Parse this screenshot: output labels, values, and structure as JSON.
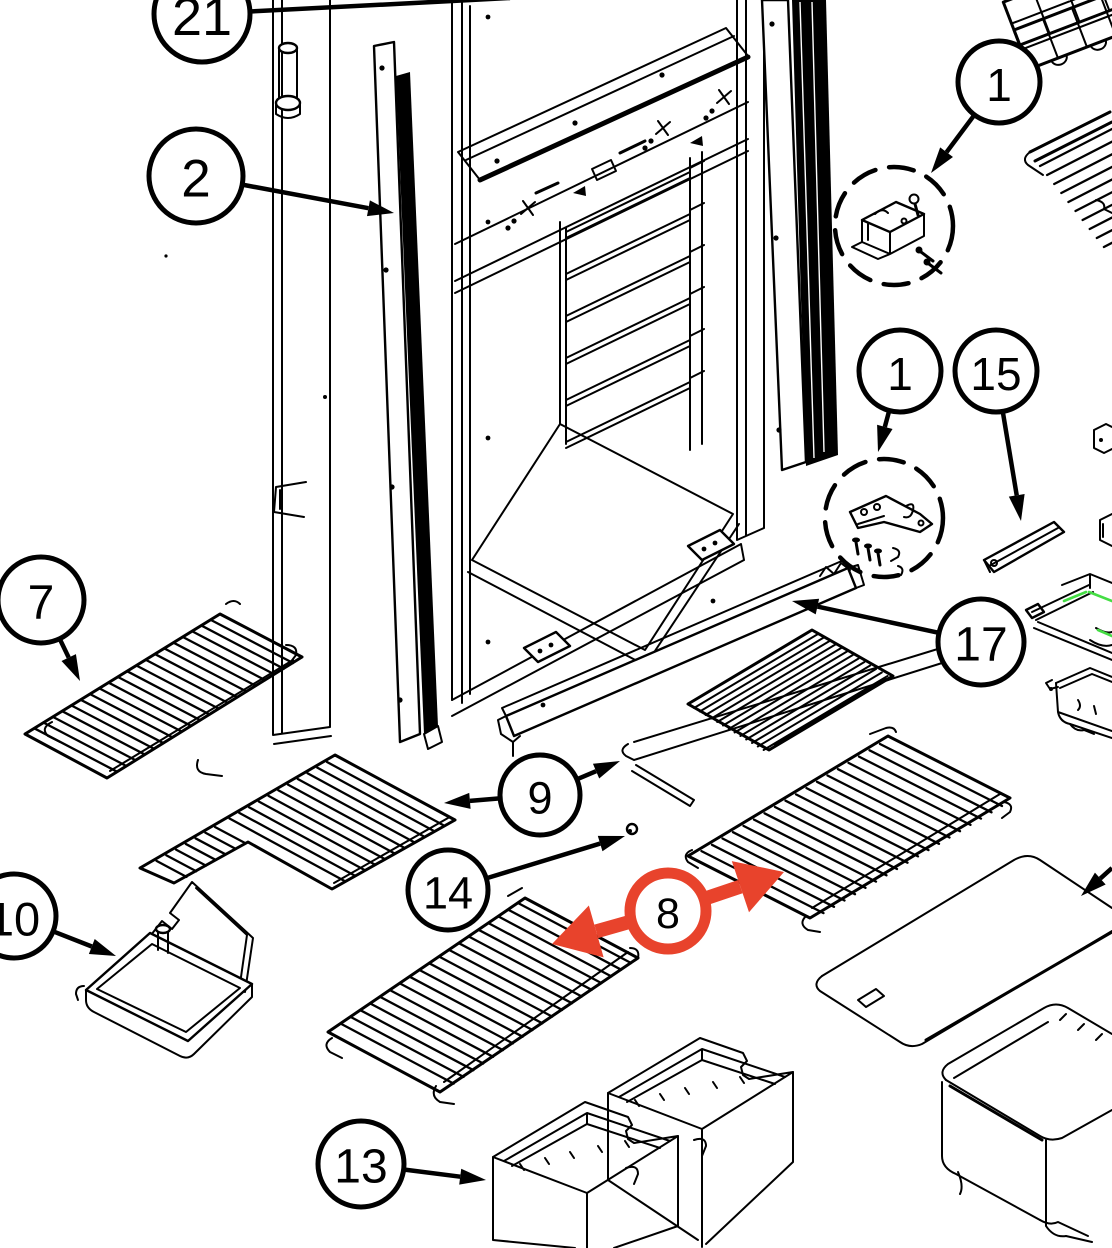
{
  "diagram": {
    "type": "exploded-parts-diagram",
    "subject": "refrigerator cabinet and shelving parts",
    "background_color": "#ffffff",
    "line_color": "#000000",
    "highlight_color": "#e8432c",
    "green_accent_color": "#44dd44",
    "callout_font_scale": 1.12,
    "callouts": [
      {
        "id": "21",
        "label": "21",
        "cx": 202,
        "cy": 14,
        "r": 48,
        "leaders": [
          {
            "x": 510,
            "y": -2,
            "head": false
          }
        ]
      },
      {
        "id": "2",
        "label": "2",
        "cx": 196,
        "cy": 176,
        "r": 47,
        "leaders": [
          {
            "x": 394,
            "y": 213
          }
        ]
      },
      {
        "id": "1-top",
        "label": "1",
        "cx": 999,
        "cy": 82,
        "r": 41,
        "leaders": [
          {
            "x": 931,
            "y": 173
          }
        ]
      },
      {
        "id": "1-mid",
        "label": "1",
        "cx": 900,
        "cy": 371,
        "r": 41,
        "leaders": [
          {
            "x": 878,
            "y": 452
          }
        ]
      },
      {
        "id": "15",
        "label": "15",
        "cx": 996,
        "cy": 371,
        "r": 41,
        "leaders": [
          {
            "x": 1021,
            "y": 521
          }
        ]
      },
      {
        "id": "17",
        "label": "17",
        "cx": 981,
        "cy": 642,
        "r": 43,
        "leaders": [
          {
            "x": 792,
            "y": 601
          }
        ]
      },
      {
        "id": "7",
        "label": "7",
        "cx": 41,
        "cy": 600,
        "r": 43,
        "leaders": [
          {
            "x": 80,
            "y": 681
          }
        ]
      },
      {
        "id": "9",
        "label": "9",
        "cx": 540,
        "cy": 795,
        "r": 40,
        "leaders": [
          {
            "x": 444,
            "y": 803
          },
          {
            "x": 620,
            "y": 761
          }
        ]
      },
      {
        "id": "14",
        "label": "14",
        "cx": 448,
        "cy": 890,
        "r": 40,
        "leaders": [
          {
            "x": 625,
            "y": 836
          }
        ]
      },
      {
        "id": "8",
        "label": "8",
        "cx": 668,
        "cy": 911,
        "r": 38,
        "style": "highlight",
        "leaders": [
          {
            "x": 552,
            "y": 944
          },
          {
            "x": 784,
            "y": 872
          }
        ]
      },
      {
        "id": "10",
        "label": "10",
        "cx": 14,
        "cy": 916,
        "r": 42,
        "leaders": [
          {
            "x": 116,
            "y": 956
          }
        ]
      },
      {
        "id": "13",
        "label": "13",
        "cx": 361,
        "cy": 1164,
        "r": 43,
        "leaders": [
          {
            "x": 486,
            "y": 1180
          }
        ]
      }
    ],
    "hardware_kit_circles": [
      {
        "id": "kit-top",
        "cx": 894,
        "cy": 226,
        "r": 59
      },
      {
        "id": "kit-mid",
        "cx": 884,
        "cy": 518,
        "r": 59
      }
    ],
    "extra_arrows": [
      {
        "x1": 1112,
        "y1": 868,
        "x2": 1081,
        "y2": 896
      }
    ]
  }
}
